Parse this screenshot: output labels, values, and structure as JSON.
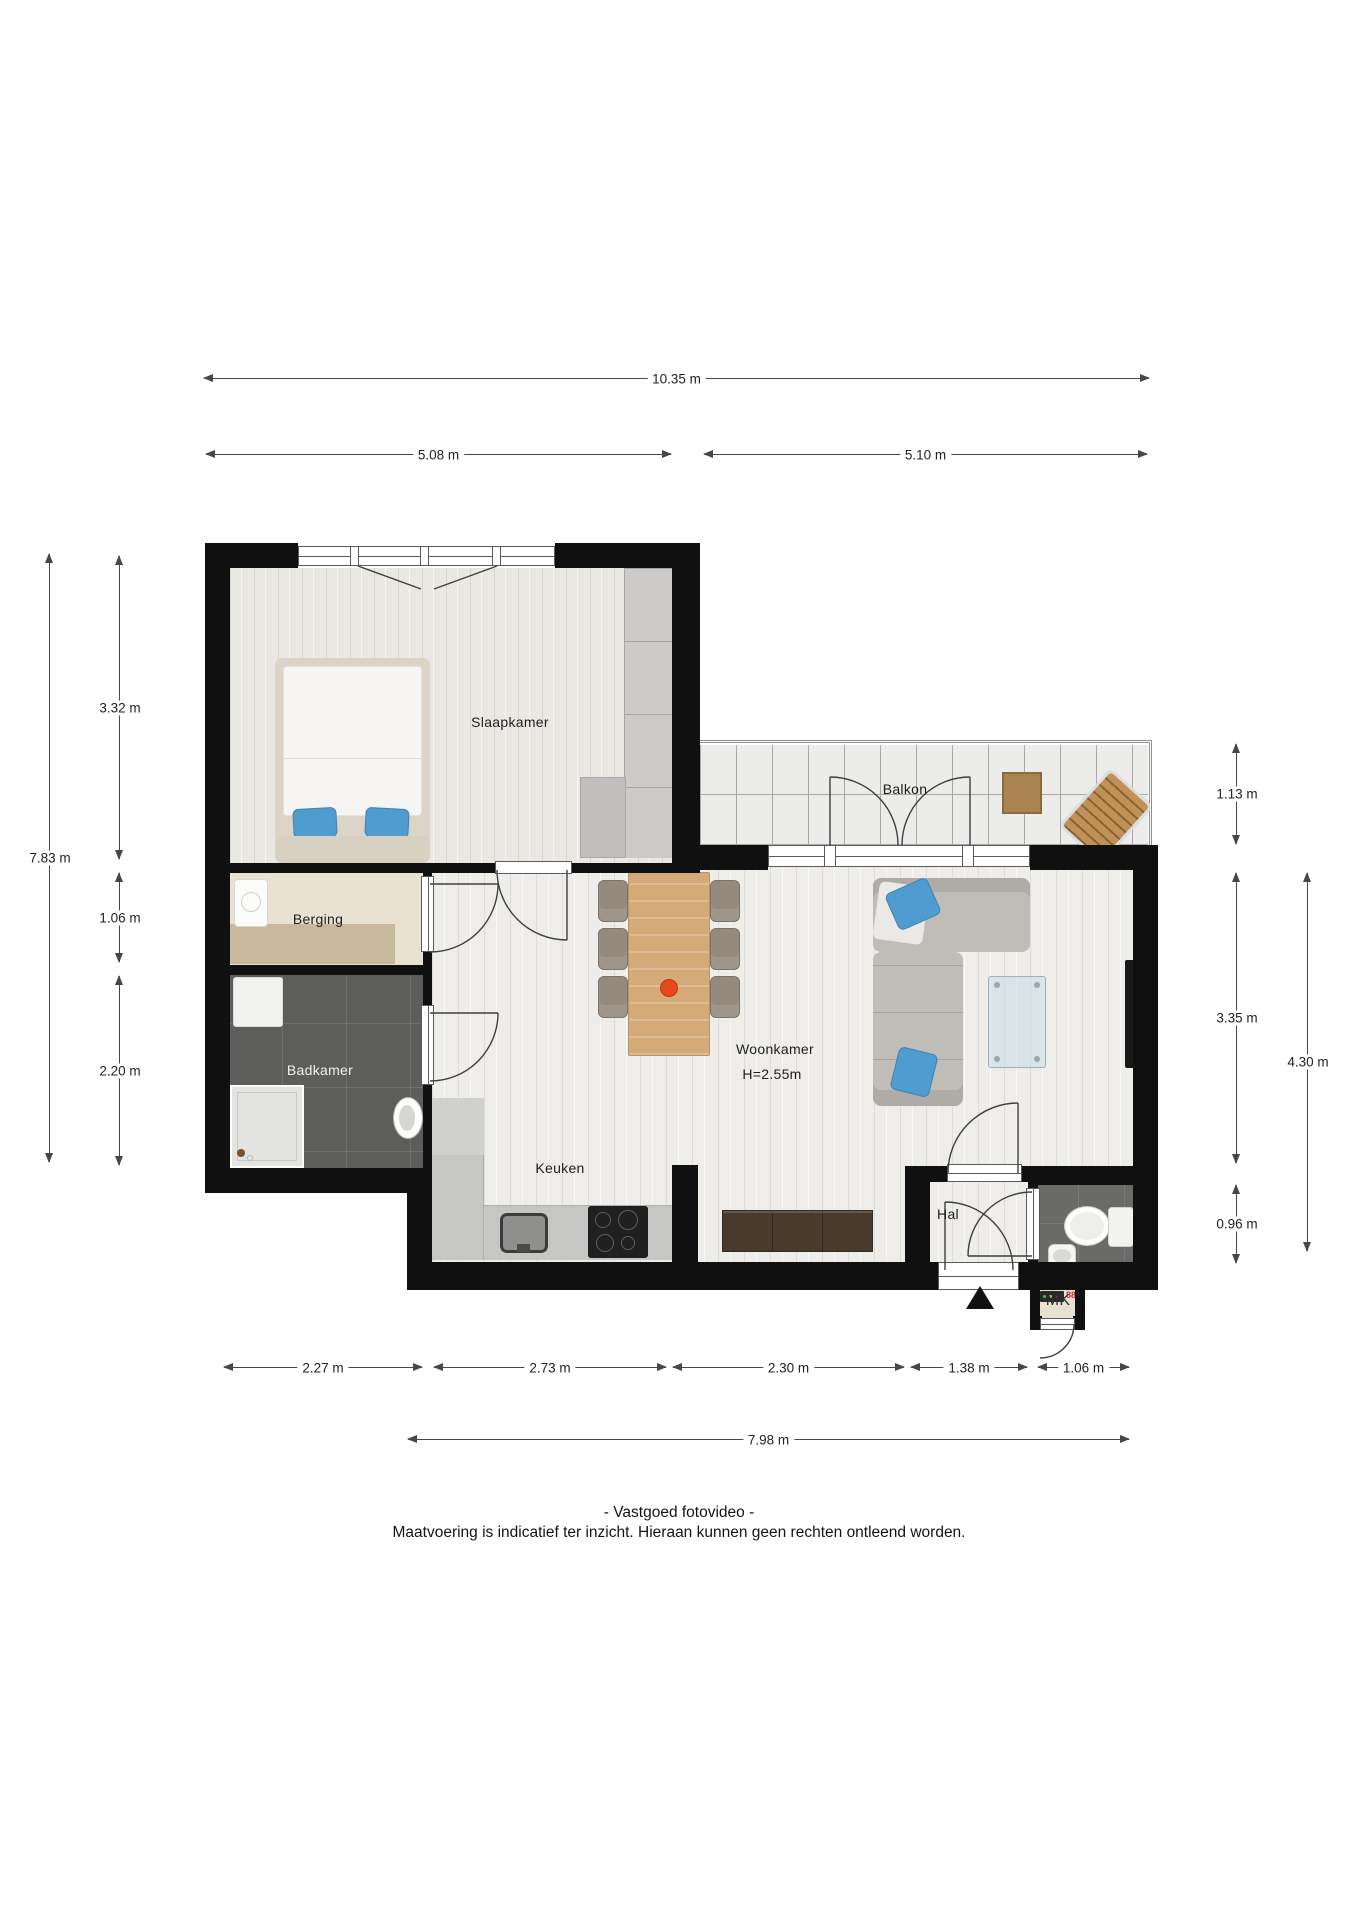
{
  "plan": {
    "rooms": {
      "slaapkamer": "Slaapkamer",
      "balkon": "Balkon",
      "berging": "Berging",
      "badkamer": "Badkamer",
      "woonkamer": "Woonkamer",
      "woonkamer_height": "H=2.55m",
      "keuken": "Keuken",
      "hal": "Hal",
      "toilet": "Toilet",
      "meterkast": "MK",
      "meterkast_display": "88"
    },
    "dimensions": {
      "total_width": "10.35 m",
      "width_left": "5.08 m",
      "width_right": "5.10 m",
      "left_segments": [
        "3.32 m",
        "1.06 m",
        "2.20 m"
      ],
      "left_total": "7.83 m",
      "right_segments": [
        "1.13 m",
        "3.35 m",
        "0.96 m"
      ],
      "right_total": "4.30 m",
      "bottom_segments": [
        "2.27 m",
        "2.73 m",
        "2.30 m",
        "1.38 m",
        "1.06 m"
      ],
      "bottom_total": "7.98 m"
    },
    "footer": {
      "line1": "- Vastgoed fotovideo -",
      "line2": "Maatvoering is indicatief ter inzicht. Hieraan kunnen geen rechten ontleend worden."
    },
    "colors": {
      "wall": "#101010",
      "accent_blue": "#4e9cd0",
      "accent_orange": "#e8481f",
      "wood_floor": "#eeede9",
      "dark_tile": "#5d5d5b"
    }
  }
}
